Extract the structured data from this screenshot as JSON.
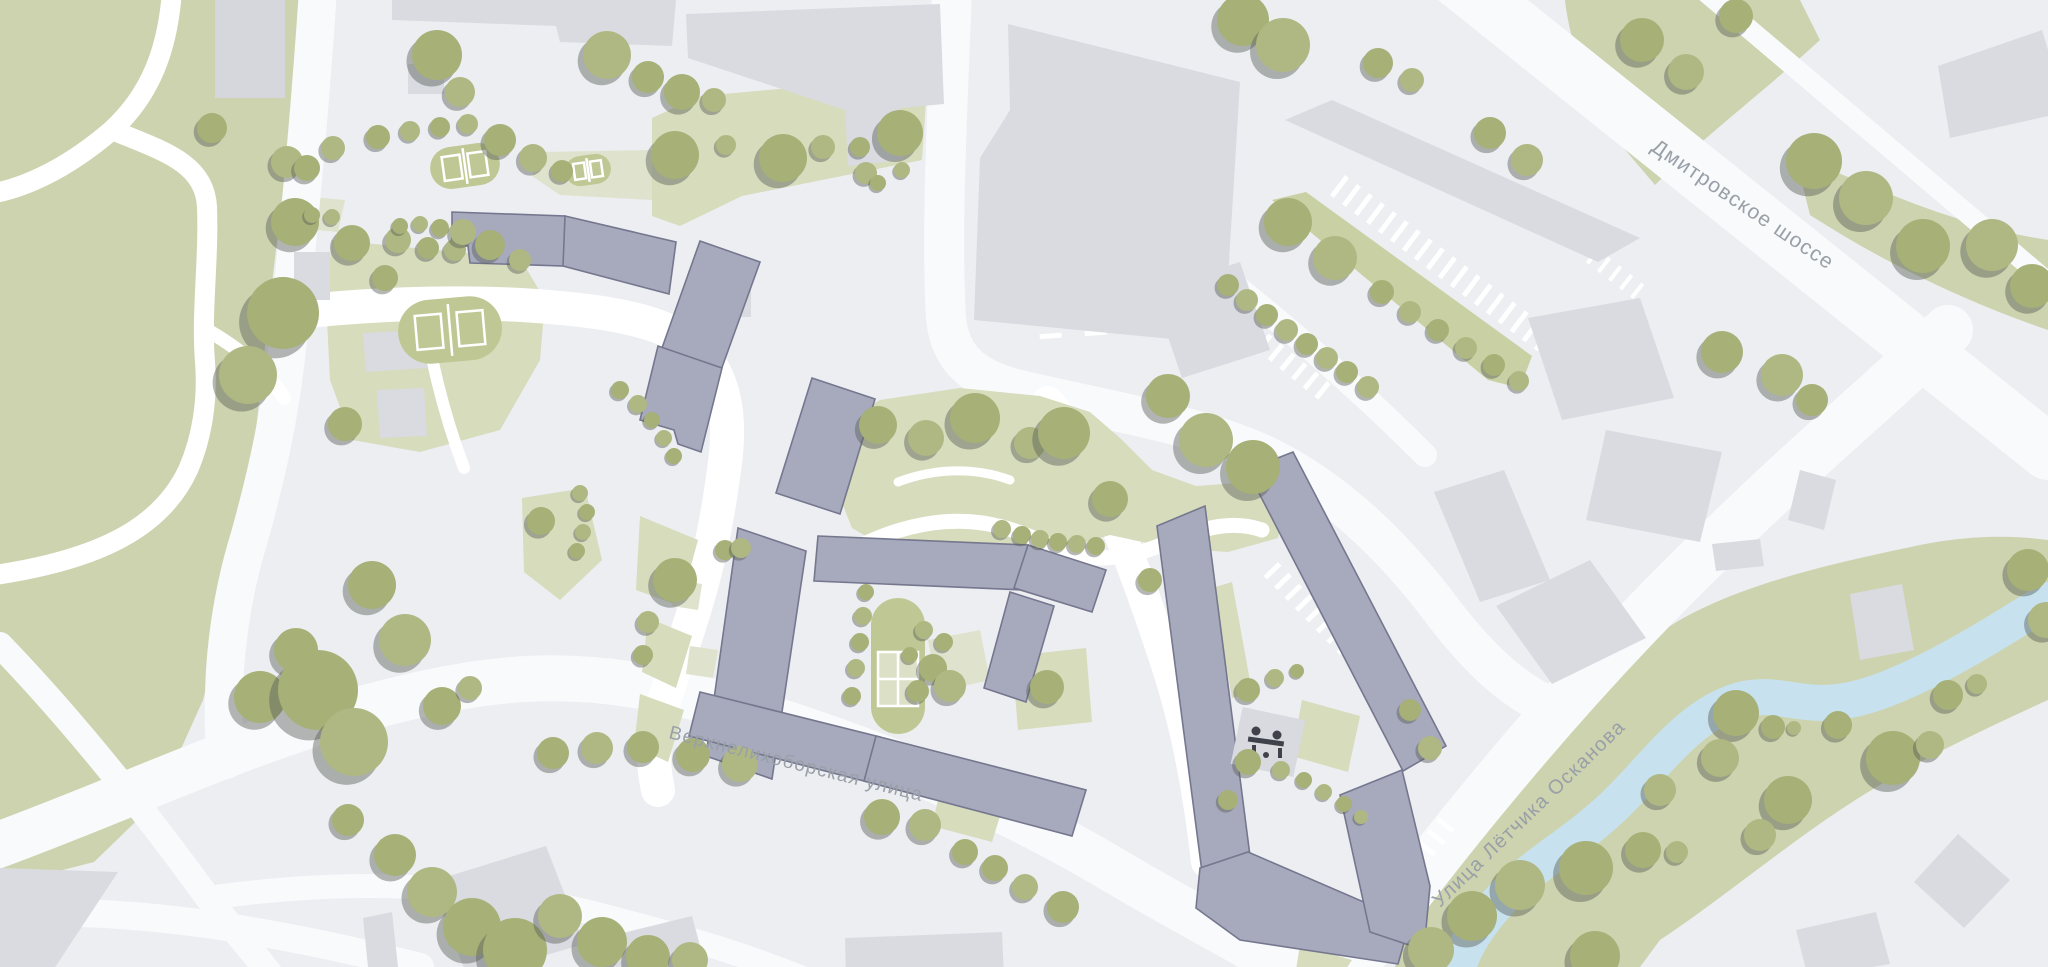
{
  "title": "Схема района (генплан)",
  "streets": {
    "dmitrovskoe": {
      "label": "Дмитровское шоссе"
    },
    "verhnelihoborskaya": {
      "label": "Верхнелихоборская улица"
    },
    "oskanova": {
      "label": "Улица Лётчика Осканова"
    }
  },
  "icons": {
    "playground": "playground-people-icon"
  },
  "colors": {
    "background": "#ECEEF2",
    "road": "#F8FAFC",
    "footpath": "#FFFFFF",
    "park_green": "#CDD3AE",
    "lawn_green": "#D6DCBC",
    "pale_green": "#DFE3CD",
    "strip_green": "#C9D0A4",
    "tree": [
      "#A6B077",
      "#AFB883",
      "#9CA66D"
    ],
    "tree_shadow": "#5A5F58",
    "context_building": "#D9DBE0",
    "project_building_fill": "#A7A9BD",
    "project_building_stroke": "#75778E",
    "river": "#C7E2EE",
    "playground": "#BFC894",
    "court_pale": "#DCE0C6",
    "street_label": "#99A0A7",
    "icon_dark": "#3F424A"
  },
  "trees": [
    [
      212,
      128,
      15,
      0
    ],
    [
      287,
      162,
      16,
      1
    ],
    [
      295,
      222,
      24,
      0
    ],
    [
      283,
      313,
      36,
      0
    ],
    [
      248,
      375,
      29,
      1
    ],
    [
      345,
      424,
      17,
      0
    ],
    [
      372,
      585,
      24,
      0
    ],
    [
      405,
      640,
      26,
      1
    ],
    [
      296,
      650,
      22,
      0
    ],
    [
      260,
      697,
      26,
      0
    ],
    [
      318,
      690,
      40,
      0
    ],
    [
      354,
      742,
      34,
      1
    ],
    [
      348,
      820,
      16,
      0
    ],
    [
      437,
      55,
      25,
      0
    ],
    [
      460,
      92,
      15,
      1
    ],
    [
      307,
      168,
      13,
      0
    ],
    [
      333,
      148,
      12,
      1
    ],
    [
      378,
      137,
      12,
      0
    ],
    [
      410,
      131,
      10,
      1
    ],
    [
      440,
      127,
      10,
      0
    ],
    [
      468,
      124,
      10,
      1
    ],
    [
      500,
      140,
      16,
      0
    ],
    [
      533,
      158,
      14,
      1
    ],
    [
      562,
      171,
      11,
      0
    ],
    [
      312,
      215,
      8,
      0
    ],
    [
      332,
      217,
      8,
      1
    ],
    [
      607,
      55,
      24,
      1
    ],
    [
      648,
      77,
      16,
      0
    ],
    [
      682,
      92,
      18,
      0
    ],
    [
      714,
      100,
      12,
      1
    ],
    [
      675,
      155,
      24,
      0
    ],
    [
      726,
      145,
      10,
      1
    ],
    [
      783,
      158,
      24,
      0
    ],
    [
      823,
      147,
      12,
      1
    ],
    [
      860,
      147,
      10,
      0
    ],
    [
      866,
      173,
      11,
      1
    ],
    [
      900,
      133,
      23,
      0
    ],
    [
      878,
      183,
      8,
      0
    ],
    [
      902,
      170,
      8,
      1
    ],
    [
      352,
      243,
      18,
      0
    ],
    [
      398,
      240,
      13,
      1
    ],
    [
      428,
      248,
      11,
      0
    ],
    [
      455,
      250,
      11,
      1
    ],
    [
      490,
      245,
      15,
      0
    ],
    [
      520,
      260,
      11,
      1
    ],
    [
      385,
      278,
      13,
      0
    ],
    [
      400,
      226,
      8,
      0
    ],
    [
      420,
      224,
      8,
      1
    ],
    [
      440,
      228,
      9,
      0
    ],
    [
      463,
      232,
      13,
      1
    ],
    [
      620,
      390,
      9,
      0
    ],
    [
      638,
      404,
      9,
      1
    ],
    [
      652,
      420,
      8,
      0
    ],
    [
      664,
      438,
      8,
      1
    ],
    [
      674,
      456,
      8,
      0
    ],
    [
      541,
      521,
      14,
      0
    ],
    [
      580,
      493,
      8,
      1
    ],
    [
      587,
      512,
      8,
      0
    ],
    [
      583,
      532,
      8,
      1
    ],
    [
      577,
      551,
      8,
      0
    ],
    [
      675,
      580,
      22,
      0
    ],
    [
      648,
      622,
      11,
      1
    ],
    [
      643,
      655,
      10,
      0
    ],
    [
      725,
      550,
      10,
      0
    ],
    [
      741,
      548,
      10,
      1
    ],
    [
      866,
      592,
      8,
      0
    ],
    [
      863,
      616,
      9,
      1
    ],
    [
      860,
      642,
      9,
      0
    ],
    [
      856,
      668,
      9,
      1
    ],
    [
      852,
      696,
      9,
      0
    ],
    [
      924,
      630,
      9,
      1
    ],
    [
      944,
      642,
      9,
      0
    ],
    [
      910,
      655,
      8,
      0
    ],
    [
      933,
      668,
      14,
      0
    ],
    [
      950,
      686,
      16,
      1
    ],
    [
      918,
      691,
      11,
      0
    ],
    [
      1047,
      687,
      17,
      0
    ],
    [
      878,
      425,
      19,
      0
    ],
    [
      926,
      438,
      18,
      1
    ],
    [
      975,
      418,
      25,
      0
    ],
    [
      1030,
      443,
      16,
      1
    ],
    [
      1064,
      433,
      26,
      0
    ],
    [
      1110,
      499,
      18,
      0
    ],
    [
      1002,
      529,
      9,
      1
    ],
    [
      1022,
      535,
      9,
      0
    ],
    [
      1040,
      539,
      9,
      1
    ],
    [
      1058,
      542,
      9,
      0
    ],
    [
      1077,
      544,
      9,
      1
    ],
    [
      1096,
      546,
      9,
      0
    ],
    [
      1150,
      580,
      12,
      0
    ],
    [
      442,
      706,
      19,
      0
    ],
    [
      470,
      688,
      12,
      1
    ],
    [
      553,
      753,
      16,
      0
    ],
    [
      597,
      748,
      16,
      1
    ],
    [
      643,
      747,
      16,
      0
    ],
    [
      693,
      755,
      17,
      0
    ],
    [
      740,
      764,
      18,
      1
    ],
    [
      882,
      817,
      18,
      0
    ],
    [
      925,
      825,
      16,
      1
    ],
    [
      965,
      852,
      13,
      0
    ],
    [
      995,
      868,
      13,
      0
    ],
    [
      1025,
      887,
      13,
      1
    ],
    [
      1063,
      907,
      16,
      0
    ],
    [
      395,
      855,
      21,
      0
    ],
    [
      432,
      892,
      25,
      1
    ],
    [
      472,
      927,
      29,
      0
    ],
    [
      515,
      950,
      32,
      0
    ],
    [
      560,
      916,
      22,
      1
    ],
    [
      602,
      942,
      25,
      0
    ],
    [
      648,
      957,
      22,
      0
    ],
    [
      690,
      960,
      18,
      1
    ],
    [
      1243,
      20,
      26,
      0
    ],
    [
      1283,
      45,
      27,
      1
    ],
    [
      1378,
      63,
      15,
      0
    ],
    [
      1412,
      80,
      12,
      1
    ],
    [
      1490,
      133,
      16,
      0
    ],
    [
      1527,
      160,
      16,
      1
    ],
    [
      1228,
      285,
      11,
      0
    ],
    [
      1247,
      300,
      11,
      1
    ],
    [
      1267,
      315,
      11,
      0
    ],
    [
      1287,
      330,
      11,
      1
    ],
    [
      1307,
      344,
      11,
      0
    ],
    [
      1327,
      358,
      11,
      1
    ],
    [
      1347,
      372,
      11,
      0
    ],
    [
      1368,
      387,
      11,
      1
    ],
    [
      1288,
      222,
      24,
      0
    ],
    [
      1335,
      258,
      22,
      1
    ],
    [
      1382,
      292,
      12,
      0
    ],
    [
      1410,
      312,
      11,
      1
    ],
    [
      1438,
      330,
      11,
      0
    ],
    [
      1466,
      348,
      11,
      1
    ],
    [
      1494,
      365,
      11,
      0
    ],
    [
      1519,
      381,
      10,
      1
    ],
    [
      1168,
      396,
      22,
      0
    ],
    [
      1206,
      440,
      27,
      1
    ],
    [
      1253,
      467,
      27,
      0
    ],
    [
      1642,
      40,
      22,
      0
    ],
    [
      1686,
      72,
      18,
      1
    ],
    [
      1736,
      16,
      17,
      0
    ],
    [
      1814,
      161,
      28,
      0
    ],
    [
      1866,
      198,
      27,
      1
    ],
    [
      1923,
      246,
      27,
      0
    ],
    [
      1992,
      245,
      26,
      1
    ],
    [
      2032,
      286,
      22,
      0
    ],
    [
      1722,
      352,
      21,
      0
    ],
    [
      1782,
      375,
      21,
      1
    ],
    [
      1812,
      400,
      16,
      0
    ],
    [
      1248,
      690,
      12,
      0
    ],
    [
      1275,
      678,
      9,
      1
    ],
    [
      1297,
      671,
      7,
      0
    ],
    [
      1248,
      762,
      13,
      0
    ],
    [
      1281,
      770,
      9,
      1
    ],
    [
      1304,
      780,
      8,
      0
    ],
    [
      1324,
      792,
      8,
      1
    ],
    [
      1344,
      804,
      8,
      0
    ],
    [
      1361,
      817,
      7,
      1
    ],
    [
      1228,
      800,
      10,
      0
    ],
    [
      1410,
      710,
      11,
      0
    ],
    [
      1430,
      748,
      12,
      1
    ],
    [
      1736,
      713,
      23,
      0
    ],
    [
      1720,
      758,
      19,
      1
    ],
    [
      1773,
      727,
      12,
      0
    ],
    [
      1794,
      728,
      7,
      1
    ],
    [
      1838,
      725,
      14,
      0
    ],
    [
      1893,
      758,
      27,
      0
    ],
    [
      1930,
      745,
      14,
      1
    ],
    [
      1948,
      695,
      15,
      0
    ],
    [
      1977,
      684,
      10,
      1
    ],
    [
      2028,
      570,
      21,
      0
    ],
    [
      2046,
      620,
      18,
      1
    ],
    [
      1788,
      800,
      24,
      0
    ],
    [
      1760,
      835,
      16,
      1
    ],
    [
      1586,
      868,
      27,
      0
    ],
    [
      1520,
      885,
      25,
      1
    ],
    [
      1472,
      916,
      25,
      0
    ],
    [
      1431,
      950,
      23,
      1
    ],
    [
      1643,
      850,
      18,
      0
    ],
    [
      1677,
      852,
      11,
      1
    ],
    [
      1595,
      956,
      25,
      0
    ],
    [
      1660,
      790,
      16,
      1
    ]
  ],
  "parking_rows": [
    {
      "x": 1345,
      "y": 175,
      "angle": 37,
      "count": 19,
      "gap": 15,
      "len": 25,
      "w": 5
    },
    {
      "x": 1050,
      "y": 168,
      "angle": 86,
      "count": 12,
      "gap": 15,
      "len": 22,
      "w": 5
    },
    {
      "x": 1096,
      "y": 180,
      "angle": 86,
      "count": 11,
      "gap": 15,
      "len": 22,
      "w": 5
    },
    {
      "x": 1222,
      "y": 296,
      "angle": 39,
      "count": 10,
      "gap": 15,
      "len": 20,
      "w": 5
    },
    {
      "x": 1278,
      "y": 562,
      "angle": 46,
      "count": 12,
      "gap": 15,
      "len": 20,
      "w": 5
    },
    {
      "x": 1390,
      "y": 880,
      "angle": -52,
      "count": 6,
      "gap": 15,
      "len": 20,
      "w": 5
    },
    {
      "x": 1597,
      "y": 248,
      "angle": 38,
      "count": 5,
      "gap": 14,
      "len": 18,
      "w": 4
    }
  ]
}
